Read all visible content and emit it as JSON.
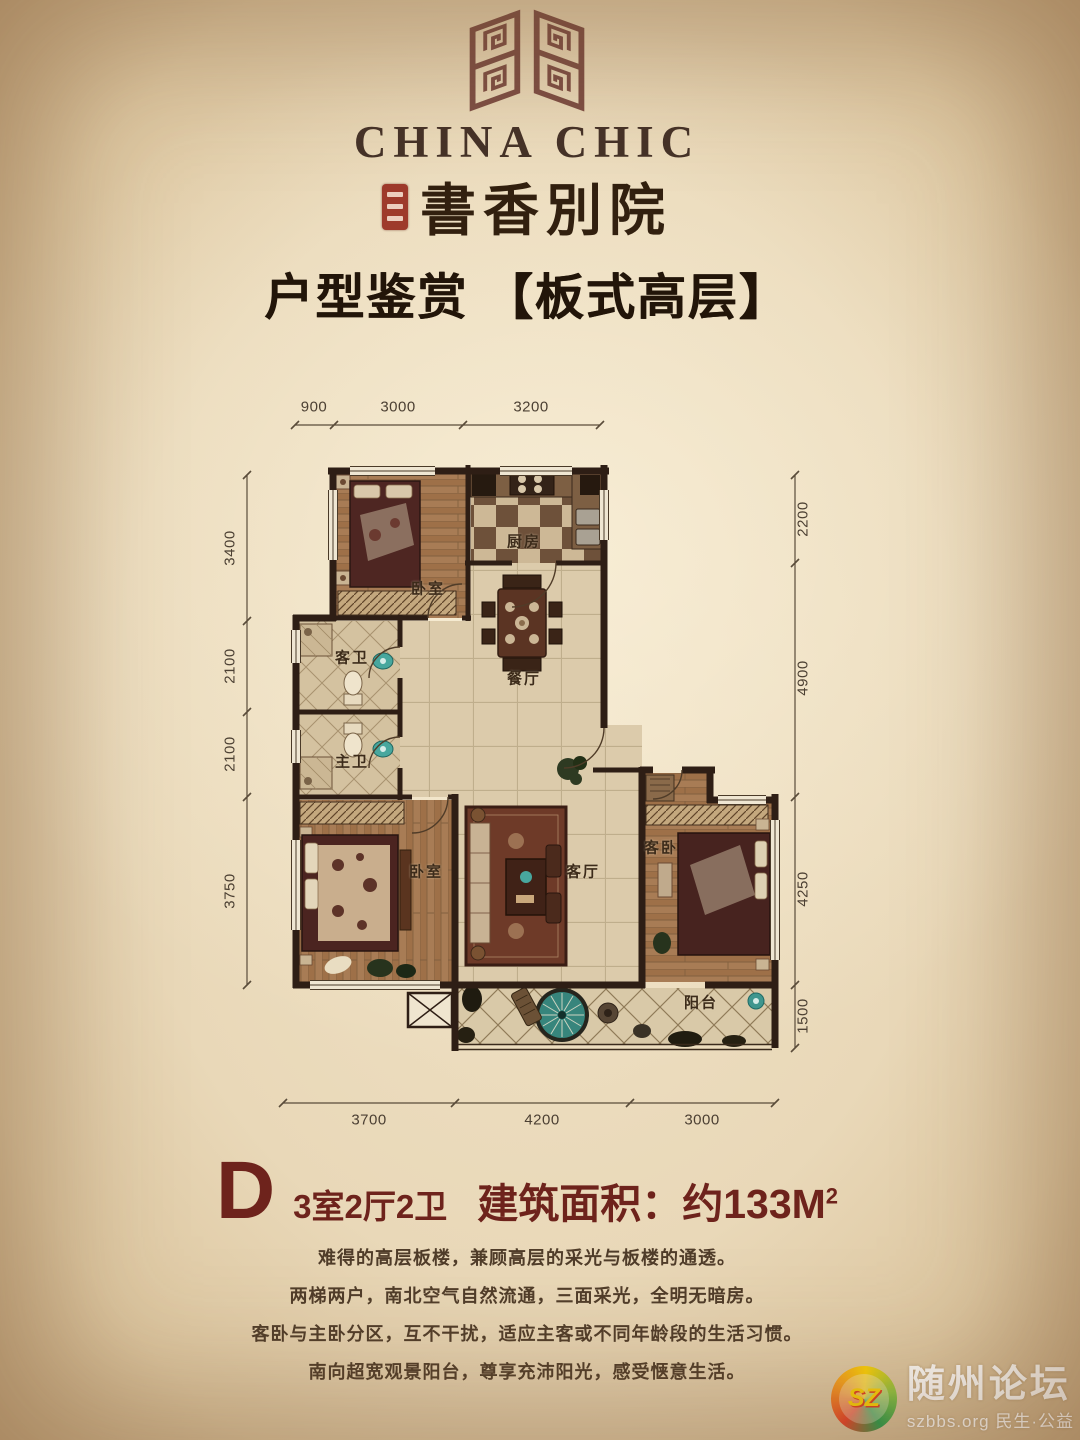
{
  "brand": {
    "logo": "china-chic-emblem",
    "name_en": "CHINA CHIC",
    "name_cn": "書香別院"
  },
  "page_title": "户型鉴赏 【板式高层】",
  "floor_plan": {
    "rooms": {
      "bedroom_top": "卧室",
      "kitchen": "厨房",
      "dining": "餐厅",
      "guest_bath": "客卫",
      "master_bath": "主卫",
      "master_bedroom": "卧室",
      "living": "客厅",
      "guest_bedroom": "客卧",
      "balcony": "阳台"
    },
    "dimensions_mm": {
      "top": [
        "900",
        "3000",
        "3200"
      ],
      "left": [
        "3400",
        "2100",
        "2100",
        "3750"
      ],
      "right": [
        "2200",
        "4900",
        "4250",
        "1500"
      ],
      "bottom": [
        "3700",
        "4200",
        "3000"
      ]
    }
  },
  "unit_info": {
    "type_letter": "D",
    "layout": "3室2厅2卫",
    "area_prefix": "建筑面积：约133M",
    "area_superscript": "2"
  },
  "description_lines": [
    "难得的高层板楼，兼顾高层的采光与板楼的通透。",
    "两梯两户，南北空气自然流通，三面采光，全明无暗房。",
    "客卧与主卧分区，互不干扰，适应主客或不同年龄段的生活习惯。",
    "南向超宽观景阳台，尊享充沛阳光，感受惬意生活。"
  ],
  "watermark": {
    "logo_initials": "SZ",
    "site_name": "随州论坛",
    "site_tagline": "szbbs.org 民生·公益"
  },
  "colors": {
    "accent_red": "#6e231c",
    "seal_red": "#9e3a2b",
    "wall": "#2e1e15",
    "paper": "#ecdcc0"
  }
}
